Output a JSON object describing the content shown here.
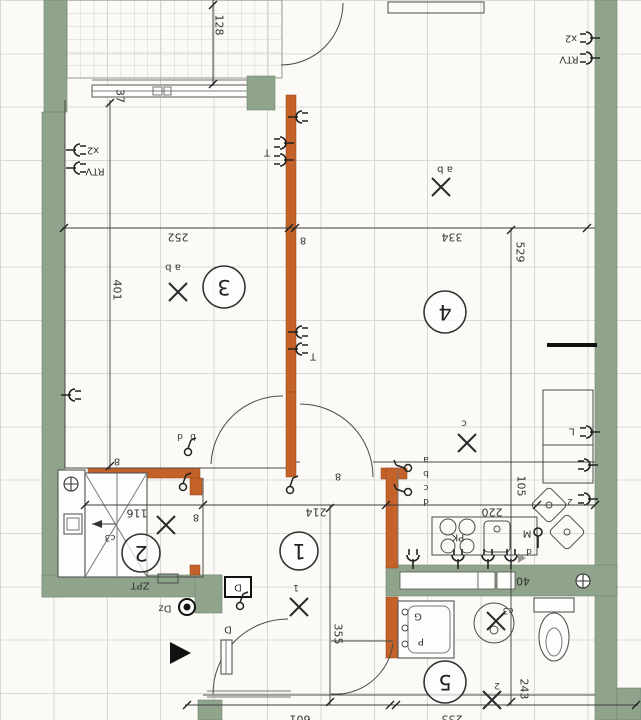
{
  "colors": {
    "structural_wall": "#8fa48b",
    "partition_wall": "#c4622a",
    "line": "#3c3c3c",
    "grid": "#d8d7cf",
    "paper": "#fbfaf6"
  },
  "rooms": [
    {
      "number": "1"
    },
    {
      "number": "2"
    },
    {
      "number": "3"
    },
    {
      "number": "4"
    },
    {
      "number": "5"
    }
  ],
  "dims": {
    "v128": "128",
    "v37": "37",
    "v252": "252",
    "v334": "334",
    "v529": "529",
    "v401": "401",
    "v116": "116",
    "v214": "214",
    "v220": "220",
    "v105": "105",
    "v355": "355",
    "v243": "243",
    "v40": "40",
    "v601": "601",
    "v233": "233",
    "v8": "8"
  },
  "labels": {
    "rtv": "RTV",
    "x2": "x2",
    "zpt": "ZPT",
    "dz": "Dz",
    "d": "D",
    "d_small": "d",
    "pk": "PK",
    "m": "M",
    "g": "G",
    "p": "P",
    "l": "L",
    "t": "T",
    "c3": "c3",
    "n1": "1",
    "n2": "2"
  },
  "light_groups": {
    "ab": "a b",
    "c": "c"
  },
  "switch_letters": [
    "a",
    "b",
    "c",
    "d"
  ]
}
